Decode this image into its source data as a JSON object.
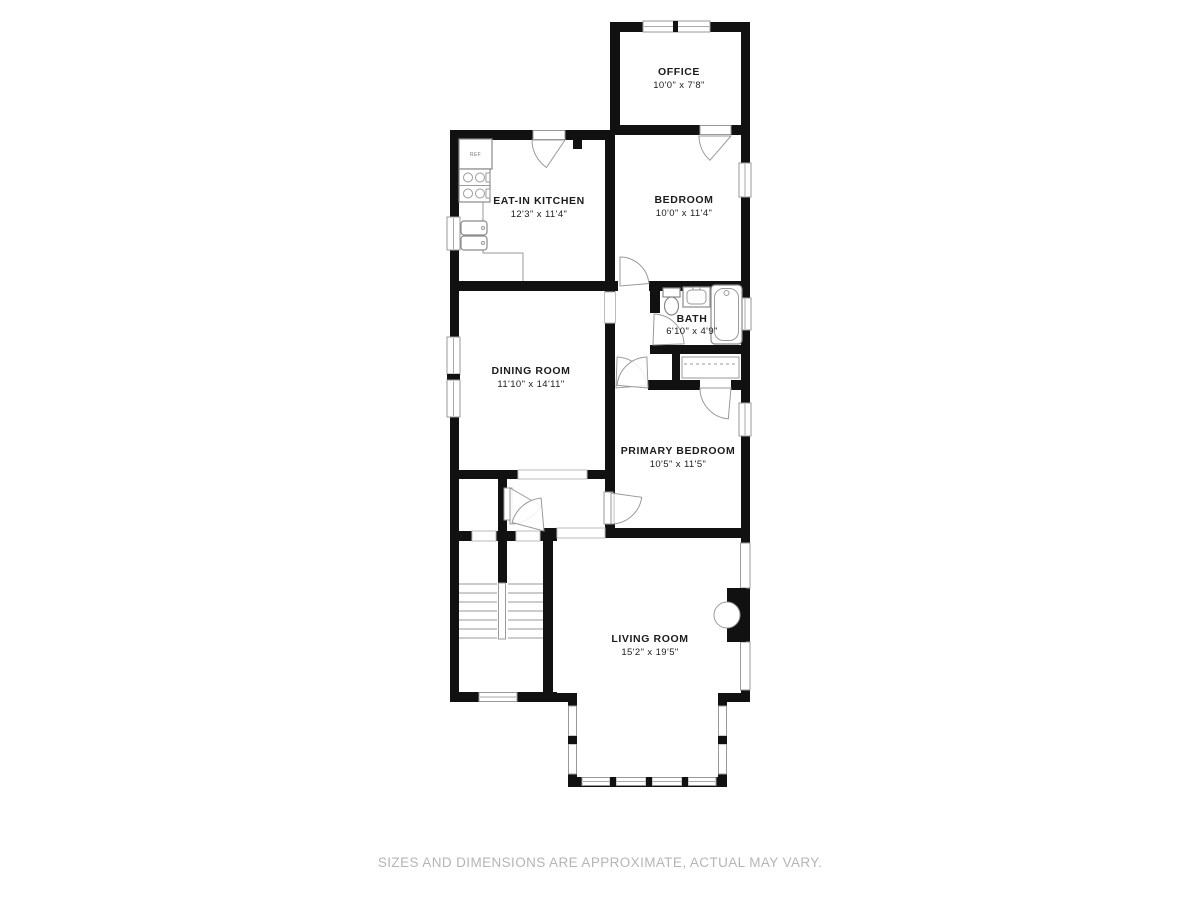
{
  "floor_plan": {
    "rooms": [
      {
        "id": "office",
        "name": "OFFICE",
        "dims": "10'0\" x 7'8\""
      },
      {
        "id": "eat_in_kitchen",
        "name": "EAT-IN KITCHEN",
        "dims": "12'3\" x 11'4\""
      },
      {
        "id": "bedroom",
        "name": "BEDROOM",
        "dims": "10'0\" x 11'4\""
      },
      {
        "id": "bath",
        "name": "BATH",
        "dims": "6'10\" x 4'9\""
      },
      {
        "id": "dining_room",
        "name": "DINING ROOM",
        "dims": "11'10\" x 14'11\""
      },
      {
        "id": "primary_bedroom",
        "name": "PRIMARY BEDROOM",
        "dims": "10'5\" x 11'5\""
      },
      {
        "id": "living_room",
        "name": "LIVING ROOM",
        "dims": "15'2\" x 19'5\""
      }
    ],
    "fixture_labels": {
      "refrigerator": "REF"
    },
    "disclaimer": "SIZES AND DIMENSIONS ARE APPROXIMATE, ACTUAL MAY VARY.",
    "colors": {
      "wall": "#111111",
      "line": "#9a9a9a",
      "label": "#1c1c1c",
      "disclaimer": "#b5b5b5"
    }
  }
}
